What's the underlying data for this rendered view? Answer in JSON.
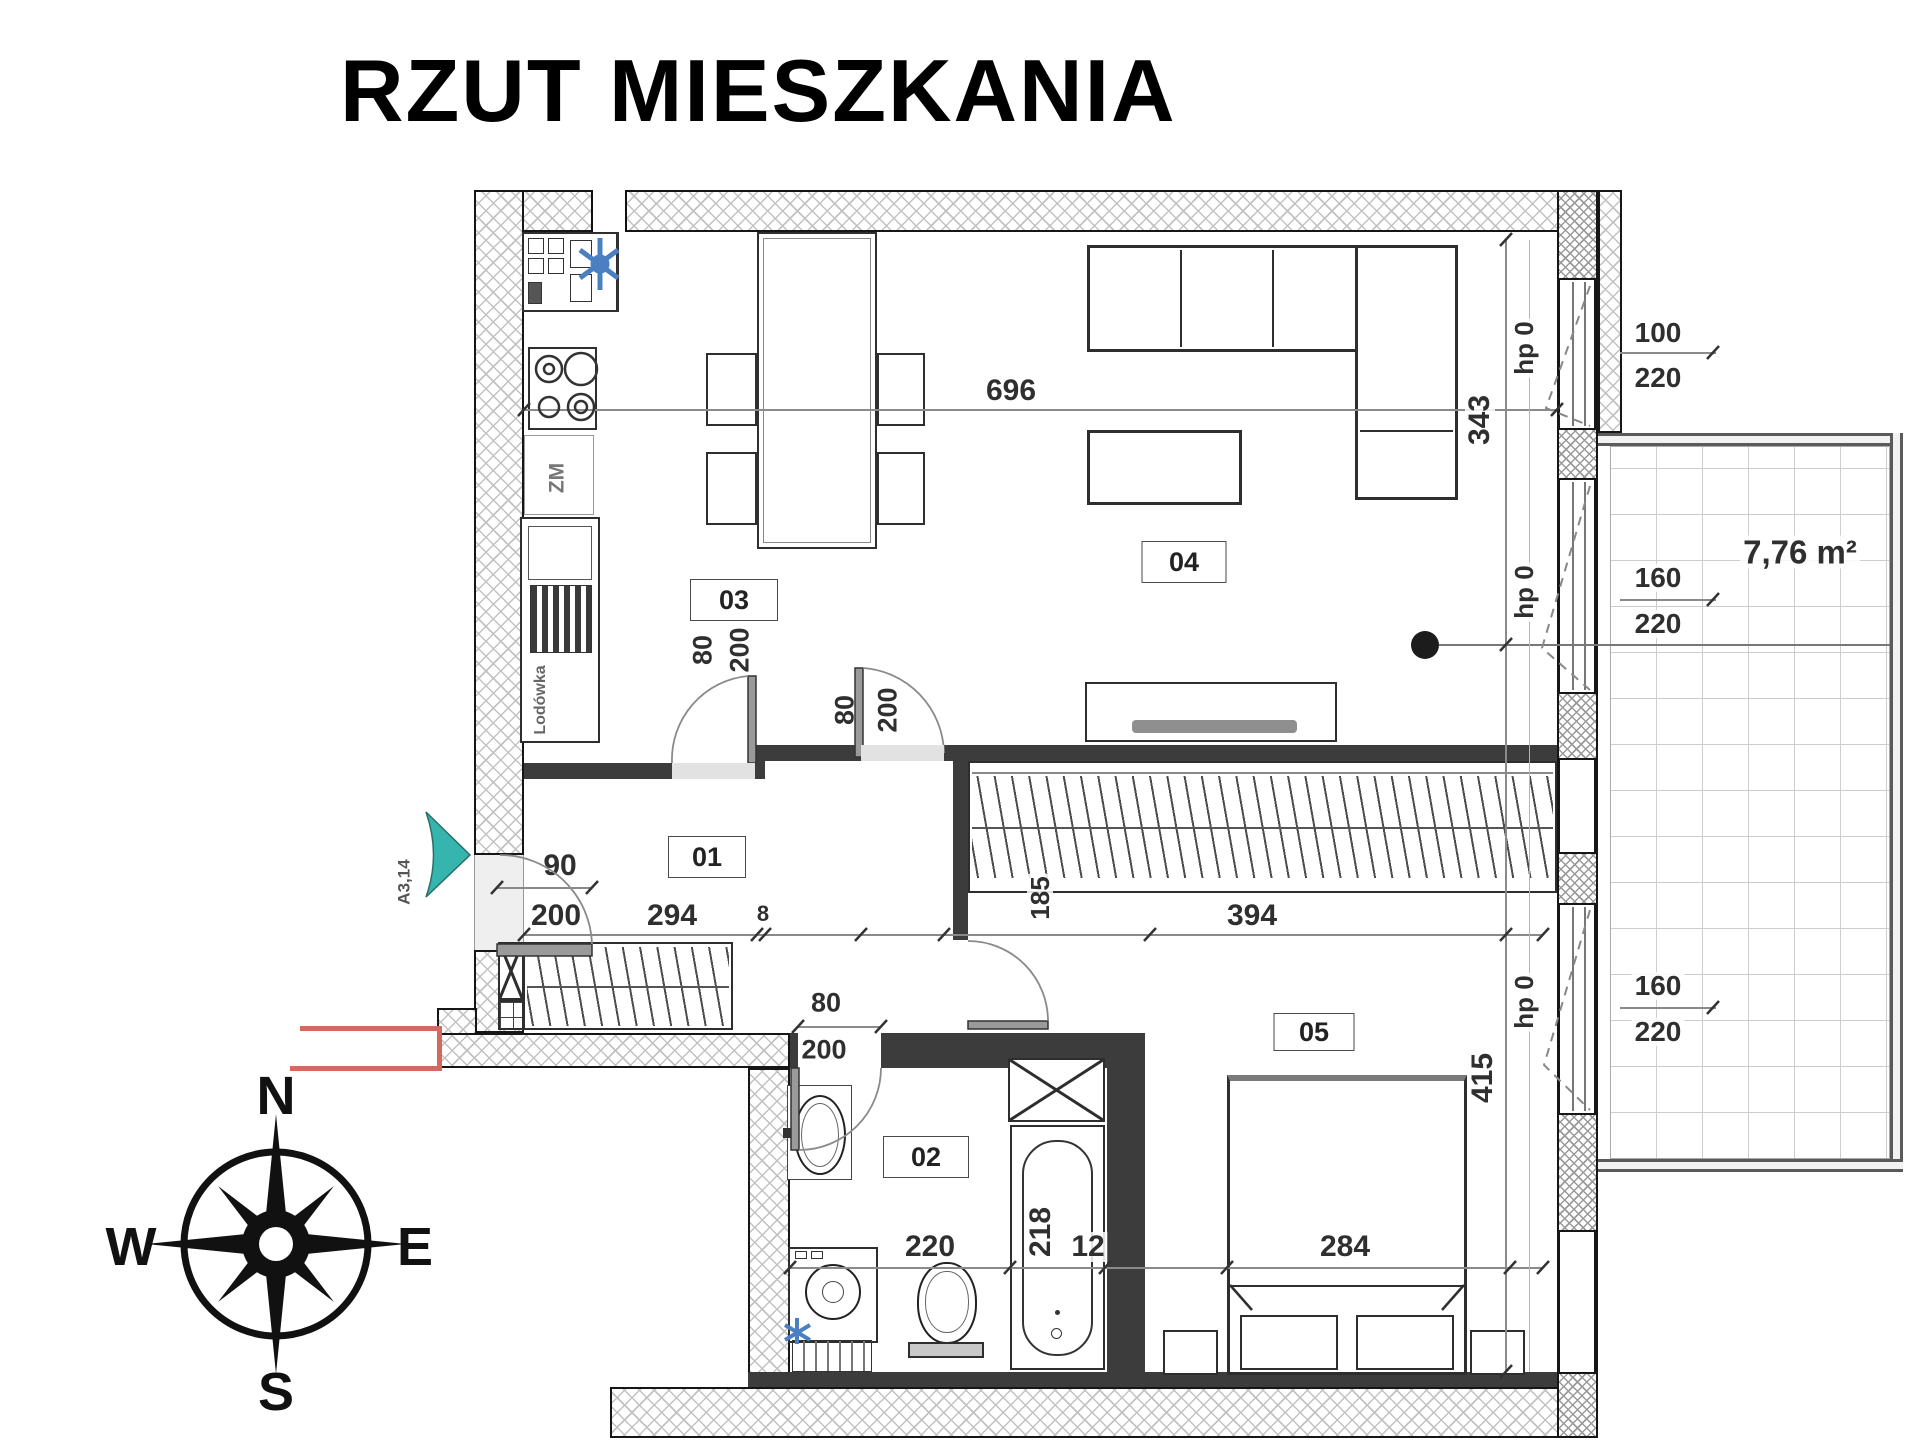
{
  "title": "RZUT MIESZKANIA",
  "rooms": {
    "hall": "01",
    "bath": "02",
    "kitchen": "03",
    "living": "04",
    "bedroom": "05"
  },
  "kitchen": {
    "dishwasher": "ZM",
    "fridge": "Lodówka"
  },
  "entrance": {
    "code": "A3,14",
    "width": "90",
    "height": "200"
  },
  "doors": {
    "kitchen": {
      "w": "80",
      "h": "200"
    },
    "living": {
      "w": "80",
      "h": "200"
    },
    "bath": {
      "w": "80",
      "h": "200"
    }
  },
  "windows": {
    "w1": {
      "w": "100",
      "h": "220",
      "hp": "hp 0"
    },
    "w2": {
      "w": "160",
      "h": "220",
      "hp": "hp 0"
    },
    "w3": {
      "w": "160",
      "h": "220",
      "hp": "hp 0"
    }
  },
  "dims": {
    "living_w": "696",
    "living_d": "343",
    "hall_w": "294",
    "seg": "8",
    "wall": "185",
    "bedroom_w": "394",
    "bedroom_d": "415",
    "bed_w": "284",
    "bath_w": "220",
    "tub_l": "218",
    "tub_gap": "12"
  },
  "balcony": {
    "area": "7,76 m²"
  },
  "compass": {
    "n": "N",
    "s": "S",
    "e": "E",
    "w": "W"
  }
}
